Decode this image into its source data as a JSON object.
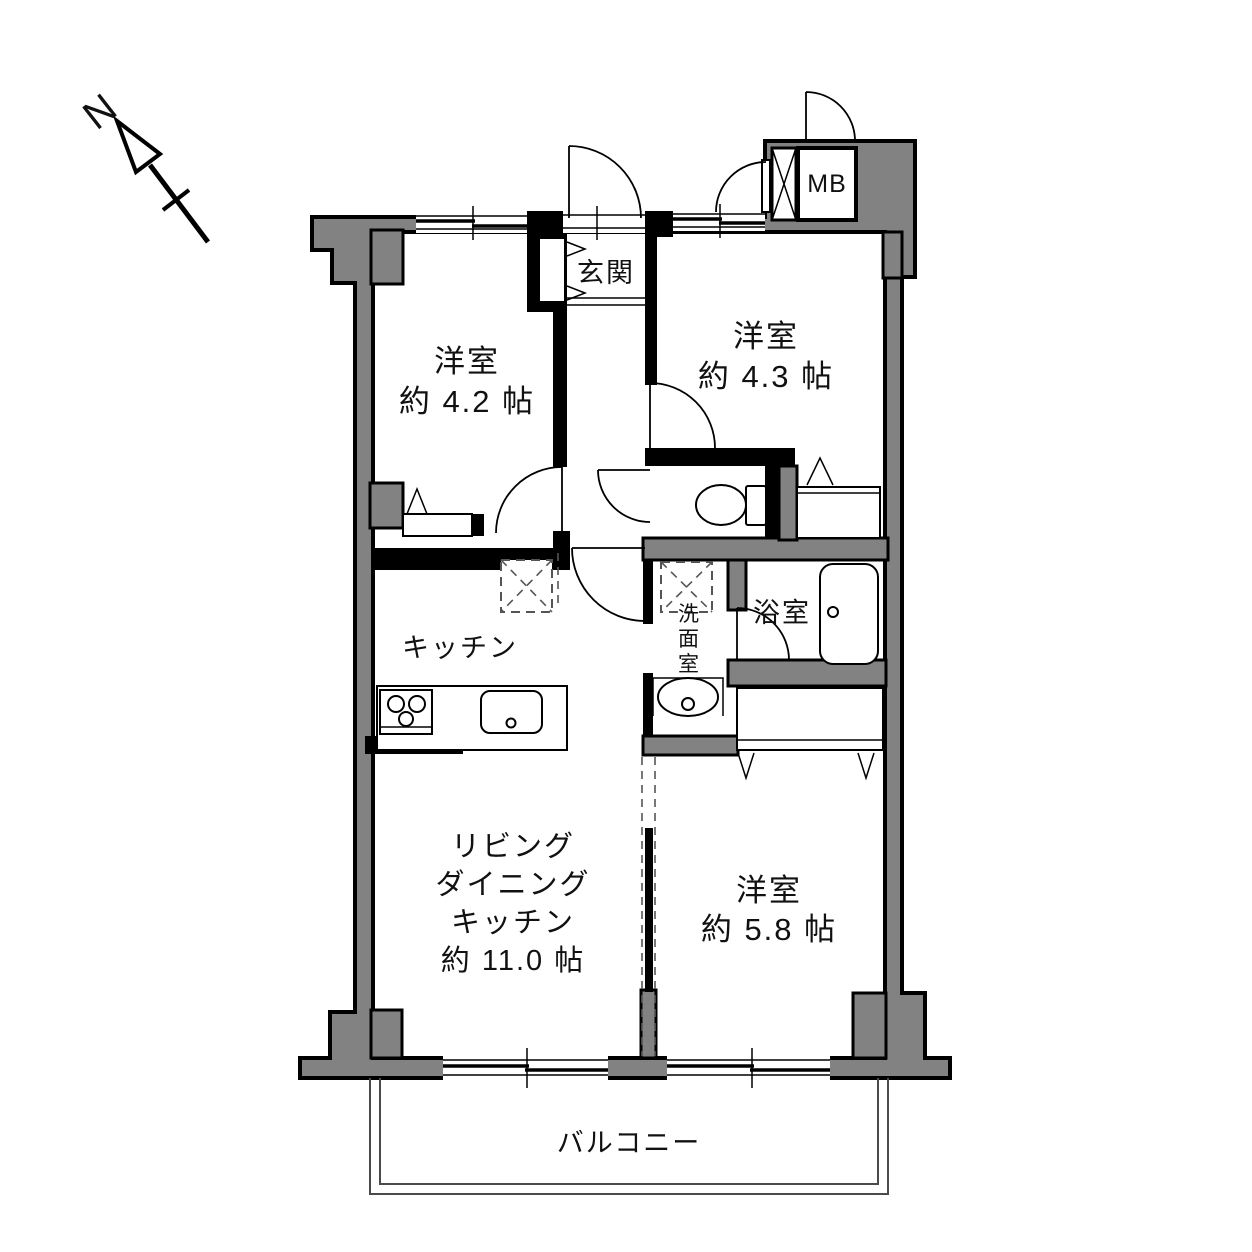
{
  "compass": {
    "north_label": "N"
  },
  "rooms": {
    "bedroom_nw": {
      "name": "洋室",
      "area": "約 4.2 帖"
    },
    "bedroom_ne": {
      "name": "洋室",
      "area": "約 4.3 帖"
    },
    "bedroom_se": {
      "name": "洋室",
      "area": "約 5.8 帖"
    },
    "ldk": {
      "line1": "リビング",
      "line2": "ダイニング",
      "line3": "キッチン",
      "area": "約 11.0 帖"
    },
    "kitchen": {
      "name": "キッチン"
    },
    "entrance": {
      "name": "玄関"
    },
    "bathroom": {
      "name": "浴室"
    },
    "washroom": {
      "chars": [
        "洗",
        "面",
        "室"
      ]
    },
    "balcony": {
      "name": "バルコニー"
    },
    "meter_box": {
      "name": "MB"
    }
  },
  "fixtures": {
    "north_arrow": "north-arrow-icon",
    "toilet": "toilet-icon",
    "bathtub": "bathtub-icon",
    "vanity_sink": "vanity-sink-icon",
    "kitchen_sink": "kitchen-sink-icon",
    "stove": "stove-icon",
    "washer_space": "washing-machine-space-icon",
    "fridge_space": "refrigerator-space-icon",
    "pipe_shaft": "pipe-shaft-icon"
  },
  "colors": {
    "wall_fill": "#828282",
    "wall_outline": "#000000",
    "background": "#ffffff",
    "text": "#111111"
  }
}
